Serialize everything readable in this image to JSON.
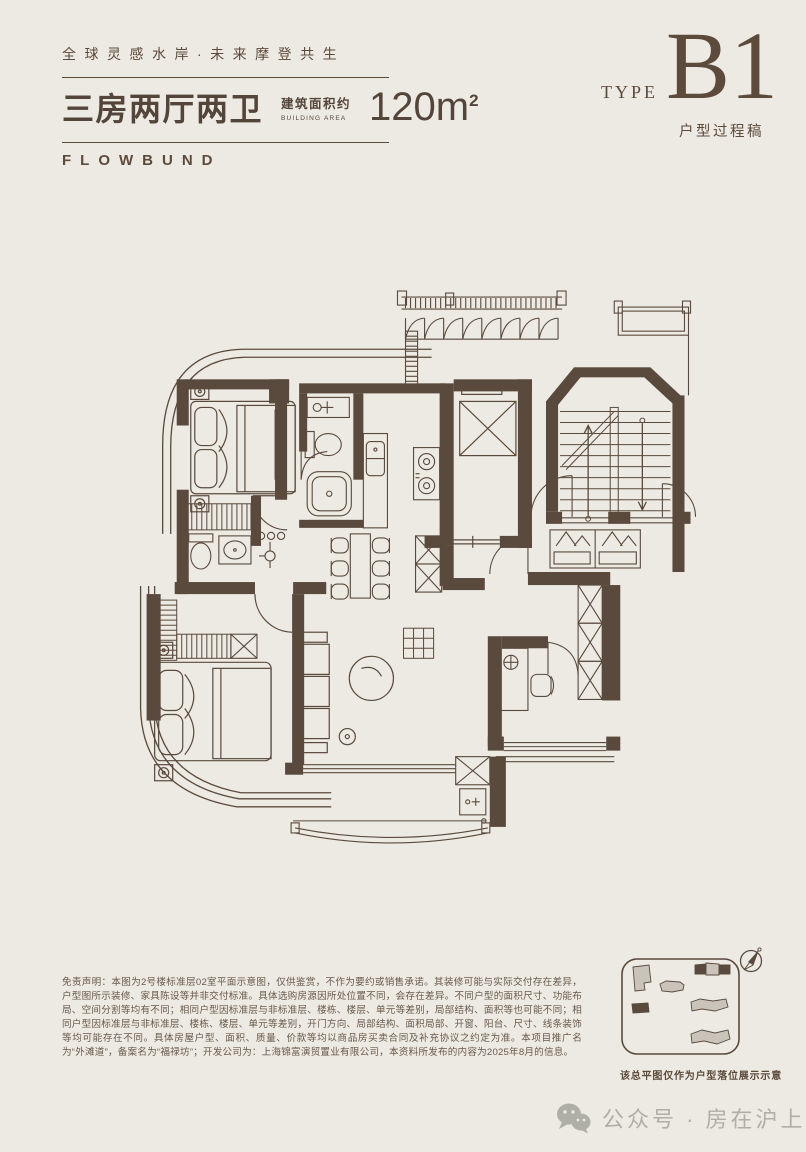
{
  "header": {
    "slogan": "全球灵感水岸·未来摩登共生",
    "unit_title": "三房两厅两卫",
    "area_label_cn": "建筑面积约",
    "area_label_en": "BUILDING AREA",
    "area_value": "120m",
    "area_superscript": "2",
    "brand": "FLOWBUND",
    "type_label": "TYPE",
    "type_code": "B1",
    "type_note": "户型过程稿"
  },
  "disclaimer": {
    "text": "免责声明：本图为2号楼标准层02室平面示意图，仅供鉴赏，不作为要约或销售承诺。其装修可能与实际交付存在差异，户型图所示装修、家具陈设等并非交付标准。具体选购房源因所处位置不同，会存在差异。不同户型的面积尺寸、功能布局、空间分割等均有不同；相同户型因标准层与非标准层、楼栋、楼层、单元等差别，局部结构、面积等也可能不同；相同户型因标准层与非标准层、楼栋、楼层、单元等差别，开门方向、局部结构、面积局部、开窗、阳台、尺寸、线条装饰等均可能存在不同。具体房屋户型、面积、质量、价款等均以商品房买卖合同及补充协议之约定为准。本项目推广名为“外滩道”，备案名为“福禄坊”；开发公司为：上海锦富演贸置业有限公司，本资料所发布的内容为2025年8月的信息。"
  },
  "siteplan": {
    "caption": "该总平图仅作为户型落位展示示意",
    "compass_icon": "compass-north-icon",
    "highlight_color": "#5A4A3D",
    "building_color": "#C9C3B9"
  },
  "watermark": {
    "text": "公众号 · 房在沪上",
    "icon": "wechat-icon"
  },
  "colors": {
    "background": "#ECEAE2",
    "ink": "#5A4A3D",
    "text": "#54453A",
    "watermark_gray": "#B0AFA7"
  }
}
